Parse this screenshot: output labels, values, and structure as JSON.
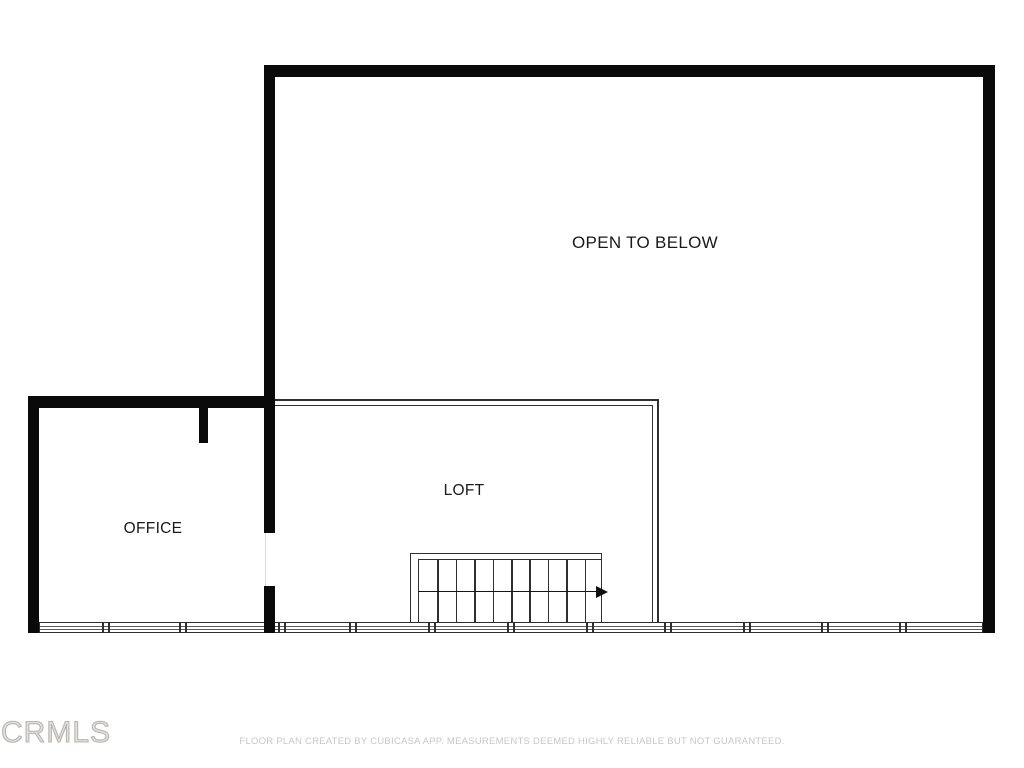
{
  "page": {
    "background_color": "#ffffff"
  },
  "floorplan": {
    "labels": {
      "open_to_below": "OPEN TO BELOW",
      "loft": "LOFT",
      "office": "OFFICE"
    },
    "stairs": {
      "tread_count": 10,
      "direction": "right"
    },
    "colors": {
      "wall": "#0a0a0a",
      "thin_wall": "#2f2f2f",
      "label_text": "#1a1a1a",
      "watermark": "#b8b5b2",
      "disclaimer": "#c7c7c7"
    }
  },
  "footer": {
    "watermark": "CRMLS",
    "disclaimer": "FLOOR PLAN CREATED BY CUBICASA APP. MEASUREMENTS DEEMED HIGHLY RELIABLE BUT NOT GUARANTEED."
  }
}
